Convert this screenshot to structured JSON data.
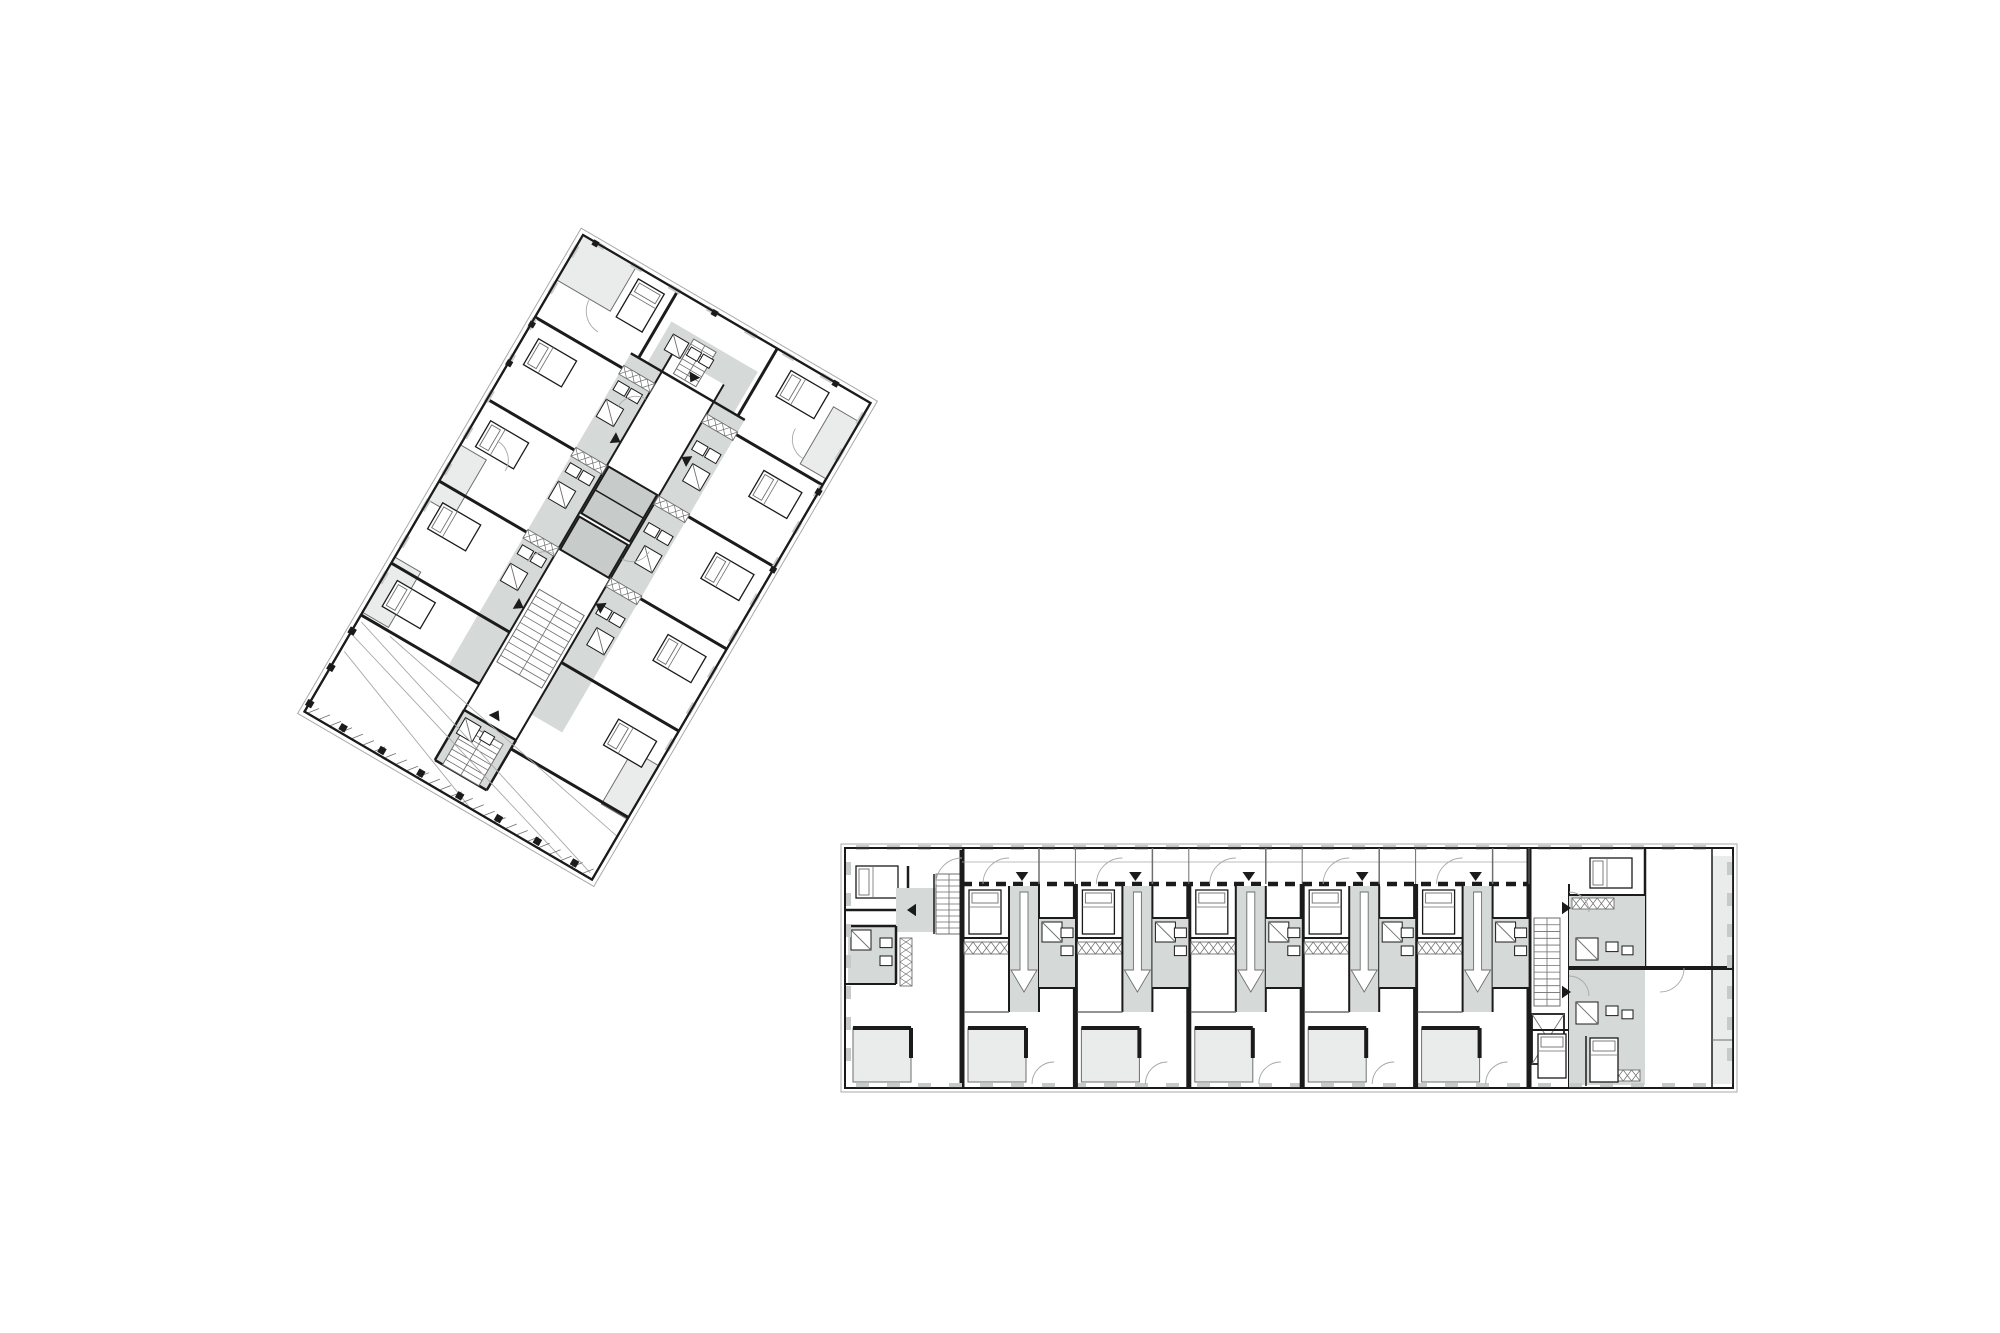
{
  "document": {
    "type": "architectural-floor-plan-sheet",
    "description": "Two residential apartment floor plans: one rotated tower slab plan (upper left) and one linear gallery-access apartment building plan (lower right)",
    "background": "#ffffff",
    "canvas": {
      "width": 2000,
      "height": 1333
    }
  },
  "palette": {
    "white": "#ffffff",
    "wall": "#1b1b1b",
    "thin": "#6e6e6e",
    "faint": "#a9a9a9",
    "circ": "#d5d9d8",
    "core": "#c7ccca",
    "balc": "#eaeceb",
    "mull": "#c6cac9"
  },
  "tower_plan": {
    "label": "rotated-tower-floor-plan",
    "origin": {
      "x": 583,
      "y": 235
    },
    "rotation_deg": 30.3,
    "width": 333,
    "height": 552,
    "prims": [
      [
        "r",
        0,
        0,
        333,
        552,
        "white",
        "wall",
        2.2
      ],
      [
        "r",
        -5,
        -5,
        343,
        562,
        null,
        "faint",
        1
      ],
      [
        "r",
        0,
        0,
        62,
        52,
        "balc",
        "thin",
        1
      ],
      [
        "r",
        303,
        22,
        30,
        66,
        "balc",
        "thin",
        1
      ],
      [
        "r",
        303,
        420,
        30,
        62,
        "balc",
        "thin",
        1
      ],
      [
        "r",
        0,
        243,
        30,
        64,
        "balc",
        "thin",
        1
      ],
      [
        "r",
        0,
        373,
        30,
        64,
        "balc",
        "thin",
        1
      ],
      [
        "r",
        101,
        78,
        36,
        362,
        "circ",
        null,
        0
      ],
      [
        "r",
        197,
        78,
        36,
        362,
        "circ",
        null,
        0
      ],
      [
        "r",
        120,
        30,
        100,
        48,
        "circ",
        null,
        0
      ],
      [
        "r",
        137,
        470,
        60,
        58,
        "circ",
        null,
        0
      ],
      [
        "r",
        137,
        58,
        60,
        412,
        "white",
        null,
        0
      ],
      [
        "r",
        139,
        187,
        56,
        54,
        "core",
        "wall",
        2
      ],
      [
        "l",
        139,
        214,
        195,
        214,
        1.5,
        "wall"
      ],
      [
        "r",
        139,
        245,
        56,
        38,
        "core",
        "wall",
        2
      ],
      [
        "l",
        0,
        95,
        137,
        95,
        3,
        "wall"
      ],
      [
        "l",
        0,
        190,
        137,
        190,
        3,
        "wall"
      ],
      [
        "l",
        0,
        285,
        137,
        285,
        3,
        "wall"
      ],
      [
        "l",
        0,
        380,
        137,
        380,
        3,
        "wall"
      ],
      [
        "l",
        0,
        440,
        137,
        440,
        3,
        "wall"
      ],
      [
        "l",
        197,
        95,
        333,
        95,
        3,
        "wall"
      ],
      [
        "l",
        197,
        190,
        333,
        190,
        3,
        "wall"
      ],
      [
        "l",
        197,
        285,
        333,
        285,
        3,
        "wall"
      ],
      [
        "l",
        197,
        380,
        333,
        380,
        3,
        "wall"
      ],
      [
        "l",
        197,
        480,
        333,
        480,
        3,
        "wall"
      ],
      [
        "l",
        110,
        0,
        110,
        78,
        3,
        "wall"
      ],
      [
        "l",
        225,
        0,
        225,
        78,
        3,
        "wall"
      ],
      [
        "l",
        101,
        78,
        233,
        78,
        2.5,
        "wall"
      ],
      [
        "l",
        137,
        58,
        137,
        470,
        2,
        "wall"
      ],
      [
        "l",
        197,
        58,
        197,
        470,
        2,
        "wall"
      ],
      [
        "l",
        137,
        470,
        197,
        470,
        2.5,
        "wall"
      ],
      [
        "l",
        137,
        470,
        137,
        528,
        2.5,
        "wall"
      ],
      [
        "l",
        197,
        470,
        197,
        528,
        2.5,
        "wall"
      ],
      [
        "l",
        137,
        528,
        197,
        528,
        2.5,
        "wall"
      ],
      [
        "hx",
        101,
        92,
        36,
        10
      ],
      [
        "hx",
        101,
        187,
        36,
        10
      ],
      [
        "hx",
        101,
        282,
        36,
        10
      ],
      [
        "hx",
        197,
        92,
        36,
        10
      ],
      [
        "hx",
        197,
        187,
        36,
        10
      ],
      [
        "hx",
        197,
        282,
        36,
        10
      ],
      [
        "st",
        141,
        328,
        52,
        84,
        11
      ],
      [
        "st",
        146,
        480,
        42,
        48,
        8
      ],
      [
        "st",
        148,
        34,
        26,
        40,
        7
      ],
      [
        "fx",
        104,
        108,
        13
      ],
      [
        "fx",
        119,
        108,
        13
      ],
      [
        "fxd",
        103,
        130,
        20
      ],
      [
        "fx",
        104,
        203,
        13
      ],
      [
        "fx",
        119,
        203,
        13
      ],
      [
        "fxd",
        103,
        225,
        20
      ],
      [
        "fx",
        104,
        298,
        13
      ],
      [
        "fx",
        119,
        298,
        13
      ],
      [
        "fxd",
        103,
        320,
        20
      ],
      [
        "fx",
        202,
        120,
        13
      ],
      [
        "fx",
        217,
        120,
        13
      ],
      [
        "fxd",
        210,
        142,
        20
      ],
      [
        "fx",
        202,
        215,
        13
      ],
      [
        "fx",
        217,
        215,
        13
      ],
      [
        "fxd",
        210,
        237,
        20
      ],
      [
        "fx",
        202,
        310,
        13
      ],
      [
        "fx",
        217,
        310,
        13
      ],
      [
        "fxd",
        210,
        332,
        20
      ],
      [
        "fxd",
        128,
        40,
        18
      ],
      [
        "fx",
        150,
        42,
        12
      ],
      [
        "fx",
        164,
        42,
        12
      ],
      [
        "fxd",
        142,
        476,
        18
      ],
      [
        "fx",
        165,
        478,
        12
      ],
      [
        "bed",
        14,
        112,
        44,
        30
      ],
      [
        "bed",
        14,
        207,
        44,
        30
      ],
      [
        "bed",
        14,
        302,
        44,
        30
      ],
      [
        "bed",
        14,
        392,
        44,
        30
      ],
      [
        "bed",
        275,
        112,
        44,
        30
      ],
      [
        "bed",
        275,
        207,
        44,
        30
      ],
      [
        "bed",
        275,
        302,
        44,
        30
      ],
      [
        "bed",
        275,
        400,
        44,
        30
      ],
      [
        "bed",
        70,
        10,
        30,
        44
      ],
      [
        "bed",
        248,
        12,
        44,
        30
      ],
      [
        "arc",
        62,
        52,
        24,
        90
      ],
      [
        "arc",
        137,
        130,
        20,
        180
      ],
      [
        "arc",
        197,
        240,
        20,
        0
      ],
      [
        "arc",
        30,
        243,
        22,
        270
      ],
      [
        "arc",
        137,
        310,
        20,
        180
      ],
      [
        "arc",
        303,
        60,
        22,
        90
      ],
      [
        "tri",
        128,
        160,
        9,
        "r"
      ],
      [
        "tri",
        128,
        352,
        9,
        "r"
      ],
      [
        "tri",
        206,
        142,
        9,
        "l"
      ],
      [
        "tri",
        206,
        312,
        9,
        "l"
      ],
      [
        "tri",
        167,
        64,
        9,
        "d"
      ],
      [
        "tri",
        167,
        462,
        9,
        "u"
      ],
      [
        "l",
        4,
        446,
        328,
        547,
        0.9,
        "faint"
      ],
      [
        "l",
        4,
        462,
        296,
        549,
        0.9,
        "faint"
      ],
      [
        "l",
        36,
        444,
        333,
        502,
        0.9,
        "faint"
      ],
      [
        "l",
        4,
        480,
        190,
        551,
        0.9,
        "faint"
      ],
      [
        "ticks",
        4,
        542,
        329,
        26
      ],
      [
        "sq",
        38,
        543,
        7
      ],
      [
        "sq",
        83,
        543,
        7
      ],
      [
        "sq",
        128,
        543,
        7
      ],
      [
        "sq",
        173,
        543,
        7
      ],
      [
        "sq",
        218,
        543,
        7
      ],
      [
        "sq",
        263,
        543,
        7
      ],
      [
        "sq",
        306,
        543,
        7
      ],
      [
        "sq",
        -3,
        455,
        7
      ],
      [
        "sq",
        -3,
        497,
        7
      ],
      [
        "sq",
        -3,
        539,
        7
      ],
      [
        "mull",
        -2,
        12,
        42,
        10,
        "v"
      ],
      [
        "mull",
        330,
        12,
        42,
        10,
        "v"
      ],
      [
        "mull",
        12,
        -2,
        44,
        7,
        "h"
      ],
      [
        "sq",
        -2,
        100,
        6
      ],
      [
        "sq",
        -2,
        145,
        6
      ],
      [
        "sq",
        330,
        100,
        6
      ],
      [
        "sq",
        330,
        190,
        6
      ],
      [
        "sq",
        12,
        -2,
        6
      ],
      [
        "sq",
        150,
        -2,
        6
      ],
      [
        "sq",
        290,
        -2,
        6
      ],
      [
        "r",
        0,
        0,
        333,
        552,
        null,
        "wall",
        2.2
      ]
    ]
  },
  "linear_plan": {
    "label": "linear-gallery-building-floor-plan",
    "x": 845,
    "y": 848,
    "width": 888,
    "height": 240,
    "prims": [
      [
        "r",
        845,
        848,
        888,
        240,
        "white",
        "wall",
        2
      ],
      [
        "r",
        841,
        844,
        896,
        248,
        null,
        "faint",
        1
      ],
      [
        "bed",
        856,
        866,
        42,
        32
      ],
      [
        "l",
        845,
        910,
        908,
        910,
        2.5,
        "wall"
      ],
      [
        "l",
        908,
        866,
        908,
        910,
        2.5,
        "wall"
      ],
      [
        "r",
        896,
        888,
        66,
        44,
        "circ",
        null,
        0
      ],
      [
        "st",
        936,
        874,
        26,
        60,
        10
      ],
      [
        "l",
        934,
        874,
        934,
        934,
        1.5,
        "wall"
      ],
      [
        "tri",
        916,
        910,
        9,
        "l"
      ],
      [
        "r",
        848,
        926,
        48,
        58,
        "circ",
        null,
        0
      ],
      [
        "fxd",
        851,
        930,
        20
      ],
      [
        "fx",
        880,
        938,
        12
      ],
      [
        "fx",
        880,
        956,
        12
      ],
      [
        "l",
        845,
        926,
        896,
        926,
        2.5,
        "wall"
      ],
      [
        "l",
        896,
        926,
        896,
        984,
        2.5,
        "wall"
      ],
      [
        "l",
        845,
        984,
        896,
        984,
        2,
        "wall"
      ],
      [
        "hx",
        900,
        938,
        12,
        48
      ],
      [
        "l",
        962,
        848,
        962,
        1088,
        5,
        "wall"
      ],
      [
        "r",
        853,
        1028,
        58,
        54,
        "balc",
        "thin",
        1
      ],
      [
        "l",
        853,
        1028,
        911,
        1028,
        4,
        "wall"
      ],
      [
        "l",
        911,
        1028,
        911,
        1058,
        4,
        "wall"
      ],
      [
        "arc",
        962,
        884,
        26,
        180
      ],
      [
        "l",
        962,
        884,
        1529,
        884,
        4.5,
        "wall",
        "10 7"
      ],
      [
        "l",
        962,
        862,
        1529,
        862,
        0.8,
        "faint"
      ],
      [
        "l",
        1529,
        848,
        1529,
        1088,
        5,
        "wall"
      ],
      [
        "l",
        1569,
        884,
        1569,
        1088,
        2,
        "wall"
      ],
      [
        "l",
        1645,
        848,
        1645,
        968,
        2.5,
        "wall"
      ],
      [
        "r",
        1712,
        856,
        21,
        228,
        "balc",
        null,
        0
      ],
      [
        "l",
        1712,
        848,
        1712,
        1088,
        1.5,
        "wall"
      ],
      [
        "l",
        1712,
        1040,
        1733,
        1040,
        1,
        "thin"
      ],
      [
        "r",
        1569,
        895,
        76,
        190,
        "circ",
        null,
        0
      ],
      [
        "l",
        1569,
        968,
        1733,
        968,
        4,
        "wall"
      ],
      [
        "l",
        1569,
        895,
        1645,
        895,
        2,
        "wall"
      ],
      [
        "bed",
        1590,
        858,
        42,
        30
      ],
      [
        "st",
        1534,
        918,
        26,
        88,
        13
      ],
      [
        "xb",
        1532,
        1014,
        32,
        50
      ],
      [
        "tri",
        1562,
        908,
        9,
        "r"
      ],
      [
        "tri",
        1562,
        992,
        9,
        "r"
      ],
      [
        "fxd",
        1576,
        938,
        22
      ],
      [
        "fxd",
        1576,
        1002,
        22
      ],
      [
        "fx",
        1606,
        942,
        12
      ],
      [
        "fx",
        1606,
        1006,
        12
      ],
      [
        "fx",
        1622,
        946,
        11
      ],
      [
        "fx",
        1622,
        1010,
        11
      ],
      [
        "hx",
        1572,
        898,
        42,
        11
      ],
      [
        "hx",
        1598,
        1070,
        42,
        11
      ],
      [
        "bed",
        1538,
        1034,
        28,
        44
      ],
      [
        "bed",
        1590,
        1038,
        28,
        44
      ],
      [
        "l",
        1529,
        1030,
        1568,
        1030,
        2,
        "wall"
      ],
      [
        "l",
        1586,
        1036,
        1586,
        1086,
        1.5,
        "wall"
      ],
      [
        "arc",
        1569,
        912,
        20,
        270
      ],
      [
        "arc",
        1569,
        996,
        20,
        270
      ],
      [
        "arc",
        1660,
        968,
        24,
        0
      ],
      [
        "mull",
        856,
        845,
        31,
        28,
        "h"
      ],
      [
        "mull",
        856,
        1083,
        31,
        28,
        "h"
      ],
      [
        "mull",
        846,
        862,
        31,
        7,
        "v"
      ],
      [
        "mull",
        1727,
        862,
        31,
        7,
        "v"
      ],
      [
        "r",
        845,
        848,
        888,
        240,
        null,
        "wall",
        1.8
      ]
    ],
    "unit_row": {
      "count": 5,
      "start_x": 962,
      "pitch": 113.4,
      "prims": [
        [
          "l",
          113.4,
          848,
          113.4,
          884,
          1,
          "thin"
        ],
        [
          "l",
          113.4,
          884,
          113.4,
          1088,
          5,
          "wall"
        ],
        [
          "l",
          77,
          848,
          77,
          884,
          1.5,
          "thin"
        ],
        [
          "tri",
          60,
          872,
          9,
          "d"
        ],
        [
          "arc",
          47,
          884,
          26,
          180
        ],
        [
          "r",
          47,
          886,
          30,
          126,
          "circ",
          null,
          0
        ],
        [
          "ba",
          62,
          892,
          100
        ],
        [
          "bed",
          7,
          890,
          32,
          44
        ],
        [
          "l",
          2,
          938,
          47,
          938,
          2,
          "wall"
        ],
        [
          "hx",
          2,
          942,
          45,
          12
        ],
        [
          "l",
          47,
          886,
          47,
          1012,
          2,
          "wall"
        ],
        [
          "l",
          77,
          886,
          77,
          1012,
          2,
          "wall"
        ],
        [
          "r",
          77,
          918,
          36,
          70,
          "circ",
          null,
          0
        ],
        [
          "fxd",
          80,
          922,
          20
        ],
        [
          "fx",
          99,
          928,
          12
        ],
        [
          "fx",
          99,
          946,
          12
        ],
        [
          "l",
          77,
          918,
          113.4,
          918,
          2,
          "wall"
        ],
        [
          "l",
          77,
          988,
          113.4,
          988,
          2,
          "wall"
        ],
        [
          "l",
          2,
          1012,
          47,
          1012,
          1.5,
          "thin"
        ],
        [
          "r",
          6,
          1028,
          58,
          54,
          "balc",
          "thin",
          1
        ],
        [
          "l",
          6,
          1028,
          64,
          1028,
          4,
          "wall"
        ],
        [
          "l",
          64,
          1028,
          64,
          1058,
          4,
          "wall"
        ],
        [
          "arc",
          92,
          1084,
          22,
          180
        ]
      ]
    }
  },
  "icon_legend": {
    "bed": "bed-icon",
    "st": "stair-icon",
    "fx": "fixture-icon",
    "fxd": "shower-icon",
    "xb": "elevator-icon",
    "tri": "entry-arrow-icon",
    "ba": "entrance-arrow-icon",
    "arc": "door-swing-icon",
    "hx": "closet-hatch-icon",
    "mull": "window-mullion-marks",
    "ticks": "facade-hatch-marks",
    "sq": "column-marker"
  }
}
